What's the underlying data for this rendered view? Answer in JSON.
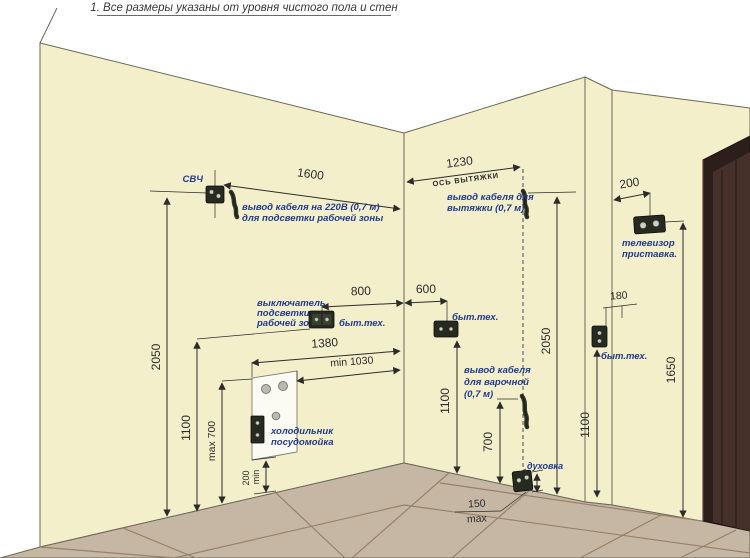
{
  "title": "1. Все размеры указаны от уровня чистого пола и стен",
  "colors": {
    "wall": "#f3efca",
    "floor": "#c6b7a4",
    "grout": "#96826b",
    "door": "#2c1f1b",
    "door_panel": "#45312a",
    "dimension": "#2b2b2b",
    "label_blue": "#223a8e"
  },
  "left_wall": {
    "svch_label": "СВЧ",
    "dim_1600": "1600",
    "cable_note_1": "вывод кабеля на 220В (0,7 м)",
    "cable_note_2": "для подсветки рабочей зоны",
    "dim_2050": "2050",
    "dim_1100": "1100",
    "switch_note_1": "выключатель",
    "switch_note_2": "подсветки",
    "switch_note_3": "рабочей зоны",
    "byt_teh": "быт.тех.",
    "dim_800": "800",
    "dim_1380": "1380",
    "dim_min_1030": "min 1030",
    "dim_max_700": "max 700",
    "dim_200": "200",
    "dim_200_suffix": "min",
    "fridge_note_1": "холодильник",
    "fridge_note_2": "посудомойка"
  },
  "middle_wall": {
    "dim_1230": "1230",
    "axis_label": "ОСЬ ВЫТЯЖКИ",
    "hood_note_1": "вывод кабеля для",
    "hood_note_2": "вытяжки (0,7 м)",
    "dim_600": "600",
    "byt_teh": "быт.тех.",
    "dim_2050": "2050",
    "dim_1100": "1100",
    "hob_note_1": "вывод кабеля",
    "hob_note_2": "для варочной",
    "hob_note_3": "(0,7 м)",
    "dim_700": "700",
    "oven_label": "духовка",
    "dim_150": "150",
    "dim_150_suffix": "max"
  },
  "right_wall": {
    "dim_200": "200",
    "tv_note_1": "телевизор",
    "tv_note_2": "приставка.",
    "dim_180": "180",
    "byt_teh": "быт.тех.",
    "dim_1100": "1100",
    "dim_1650": "1650"
  }
}
